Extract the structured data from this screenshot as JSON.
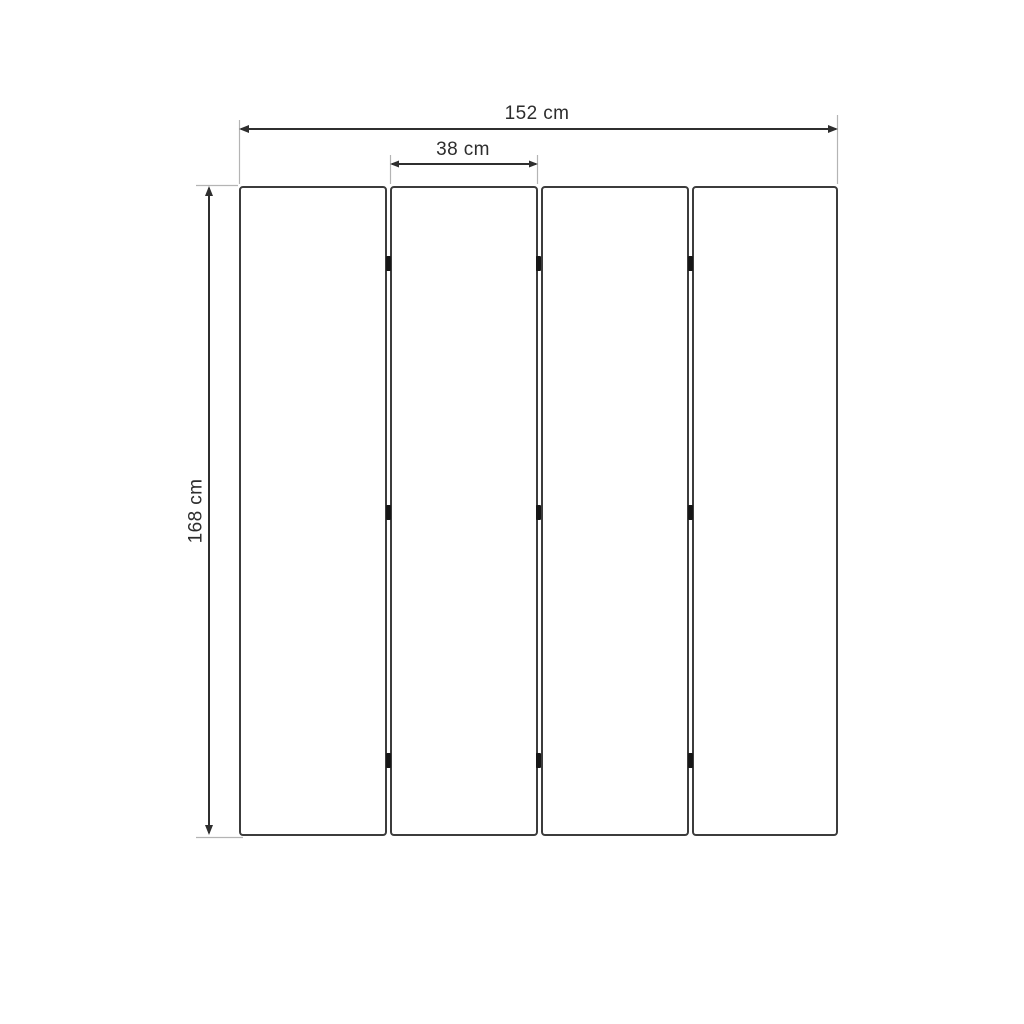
{
  "diagram": {
    "kind": "technical dimension drawing",
    "subject": "four-panel folding screen, front elevation",
    "labels": {
      "total_width": "152 cm",
      "panel_width": "38 cm",
      "height": "168 cm"
    },
    "panels": {
      "count": 4,
      "hinge_columns": 3,
      "hinge_rows": 3
    },
    "colors": {
      "background": "#ffffff",
      "outline": "#3c3c3c",
      "dimension_line": "#2f2f2f",
      "extension_line": "#b4b4b4",
      "hinge": "#161616",
      "label_text": "#2d2d2d"
    }
  }
}
